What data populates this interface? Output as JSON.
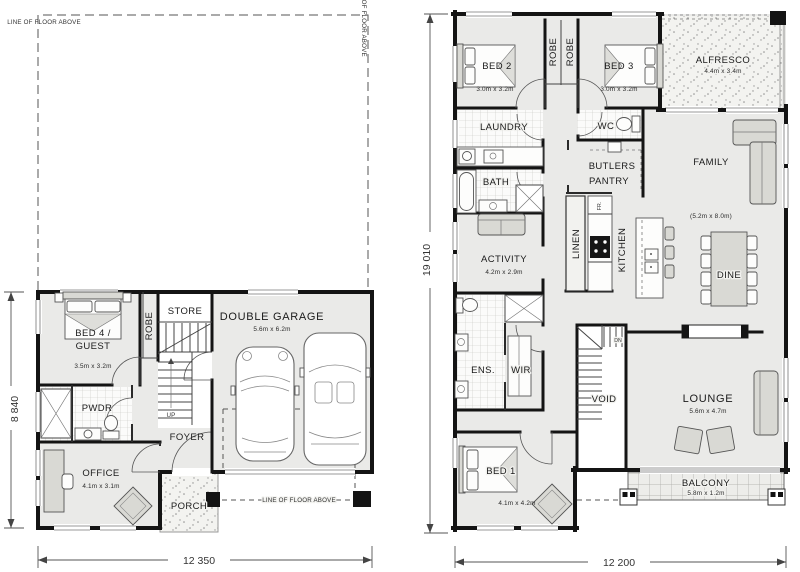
{
  "ground": {
    "floor_above_label": "LINE OF FLOOR ABOVE",
    "dim_width": "12 350",
    "dim_height": "8 840",
    "labels": {
      "bed4_line1": "BED 4 /",
      "bed4_line2": "GUEST",
      "bed4_size": "3.5m x 3.2m",
      "robe": "ROBE",
      "store": "STORE",
      "garage": "DOUBLE GARAGE",
      "garage_size": "5.6m x 6.2m",
      "pwdr": "PWDR",
      "up": "UP",
      "foyer": "FOYER",
      "porch": "PORCH",
      "office": "OFFICE",
      "office_size": "4.1m x 3.1m"
    }
  },
  "first": {
    "dim_width": "12 200",
    "dim_height": "19 010",
    "labels": {
      "bed2": "BED 2",
      "bed2_size": "3.0m x 3.2m",
      "bed3": "BED 3",
      "bed3_size": "3.0m x 3.2m",
      "robe_left": "ROBE",
      "robe_right": "ROBE",
      "alfresco": "ALFRESCO",
      "alfresco_size": "4.4m x 3.4m",
      "laundry": "LAUNDRY",
      "wc": "WC",
      "bath": "BATH",
      "butlers_line1": "BUTLERS",
      "butlers_line2": "PANTRY",
      "family": "FAMILY",
      "family_size": "(5.2m x 8.0m)",
      "activity": "ACTIVITY",
      "activity_size": "4.2m x 2.9m",
      "linen": "LINEN",
      "kitchen": "KITCHEN",
      "fridge": "FR.",
      "dine": "DINE",
      "ens": "ENS.",
      "wir": "WIR",
      "void": "VOID",
      "dn": "DN",
      "lounge": "LOUNGE",
      "lounge_size": "5.6m x 4.7m",
      "bed1": "BED 1",
      "bed1_size": "4.1m x 4.2m",
      "balcony": "BALCONY",
      "balcony_size": "5.8m x 1.2m"
    }
  },
  "colors": {
    "wall": "#141414",
    "floor": "#eaeae8",
    "text": "#1b1b1b"
  }
}
